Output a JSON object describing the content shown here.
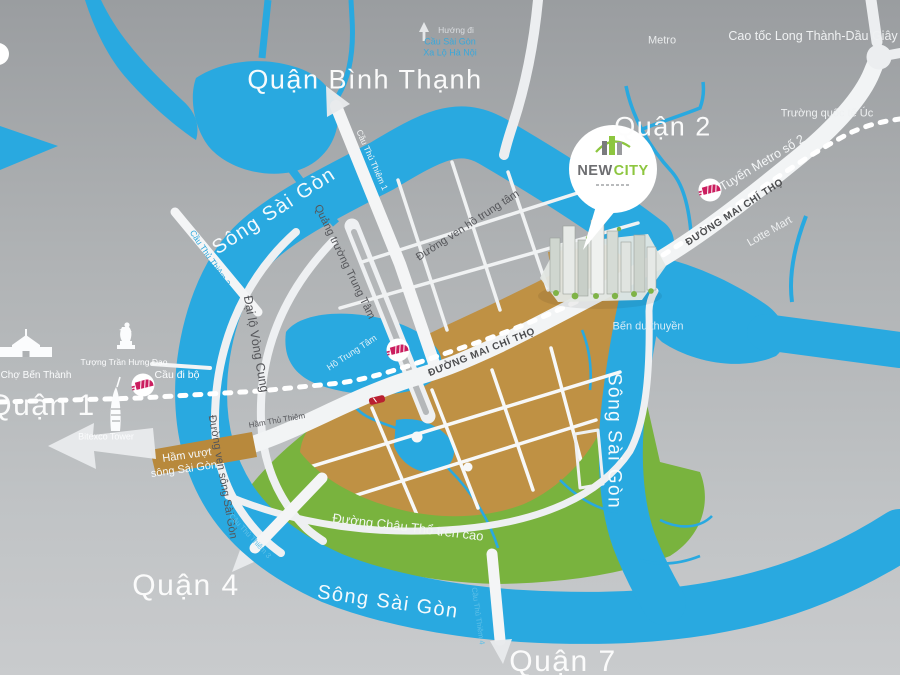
{
  "districts": {
    "binh_thanh": "Quận Bình Thạnh",
    "district_2": "Quận 2",
    "district_1": "Quận 1",
    "district_4": "Quận 4",
    "district_7": "Quận 7"
  },
  "waterways": {
    "song_sai_gon_nw": "Sông Sài Gòn",
    "song_sai_gon_e": "Sông Sài Gòn",
    "song_sai_gon_s": "Sông Sài Gòn",
    "ho_trung_tam": "Hồ Trung Tâm",
    "ben_du_thuyen": "Bến du thuyền"
  },
  "roads": {
    "metro": "Metro",
    "cao_toc": "Cao tốc Long Thành-Dầu Giây",
    "tuyen_metro_so_2": "Tuyến Metro số 2",
    "duong_mai_chi_tho_ne": "ĐƯỜNG MAI CHÍ THỌ",
    "duong_mai_chi_tho_sw": "ĐƯỜNG MAI CHÍ THỌ",
    "dai_lo_vong_cung": "Đại lộ Vòng Cung",
    "quang_truong_trung_tam": "Quảng trường Trung Tâm",
    "duong_ven_ho_trung_tam": "Đường ven hồ trung tâm",
    "duong_ven_song_sai_gon": "Đường ven sông Sài Gòn",
    "duong_chau_tho_tren_cao": "Đường Châu Thổ trên cao",
    "ham_thu_thiem": "Hầm Thủ Thiêm",
    "ham_vuot_line1": "Hầm vượt",
    "ham_vuot_line2": "sông Sài Gòn"
  },
  "bridges": {
    "cau_thu_thiem_1": "Cầu Thủ Thiêm 1",
    "cau_thu_thiem_2": "Cầu Thủ Thiêm 2",
    "cau_thu_thiem_3": "Cầu Thủ Thiêm 3",
    "cau_thu_thiem_4": "Cầu Thủ Thiêm 4",
    "cau_di_bo": "Cầu đi bộ"
  },
  "landmarks": {
    "cho_ben_thanh": "Chợ Bến Thành",
    "tuong_tran_hung_dao": "Tượng Trần Hưng Đạo",
    "bitexco_tower": "Bitexco Tower",
    "lotte_mart": "Lotte Mart",
    "truong_quoc_te_uc": "Trường quốc tế Úc"
  },
  "directions": {
    "huong_di": "Hướng đi",
    "cau_sai_gon": "Cầu Sài Gòn",
    "xa_lo_ha_noi": "Xa Lộ Hà Nội"
  },
  "project": {
    "name_part1": "NEW",
    "name_part2": "CITY"
  },
  "colors": {
    "water": "#29A9E0",
    "greenery": "#79B33E",
    "urban_gold": "#BF9144",
    "tunnel_gold": "#B8893C",
    "road_white": "#F2F4F5",
    "label_dark": "#55565A",
    "metro_pink": "#CB1E5F",
    "car_red": "#B92031"
  }
}
